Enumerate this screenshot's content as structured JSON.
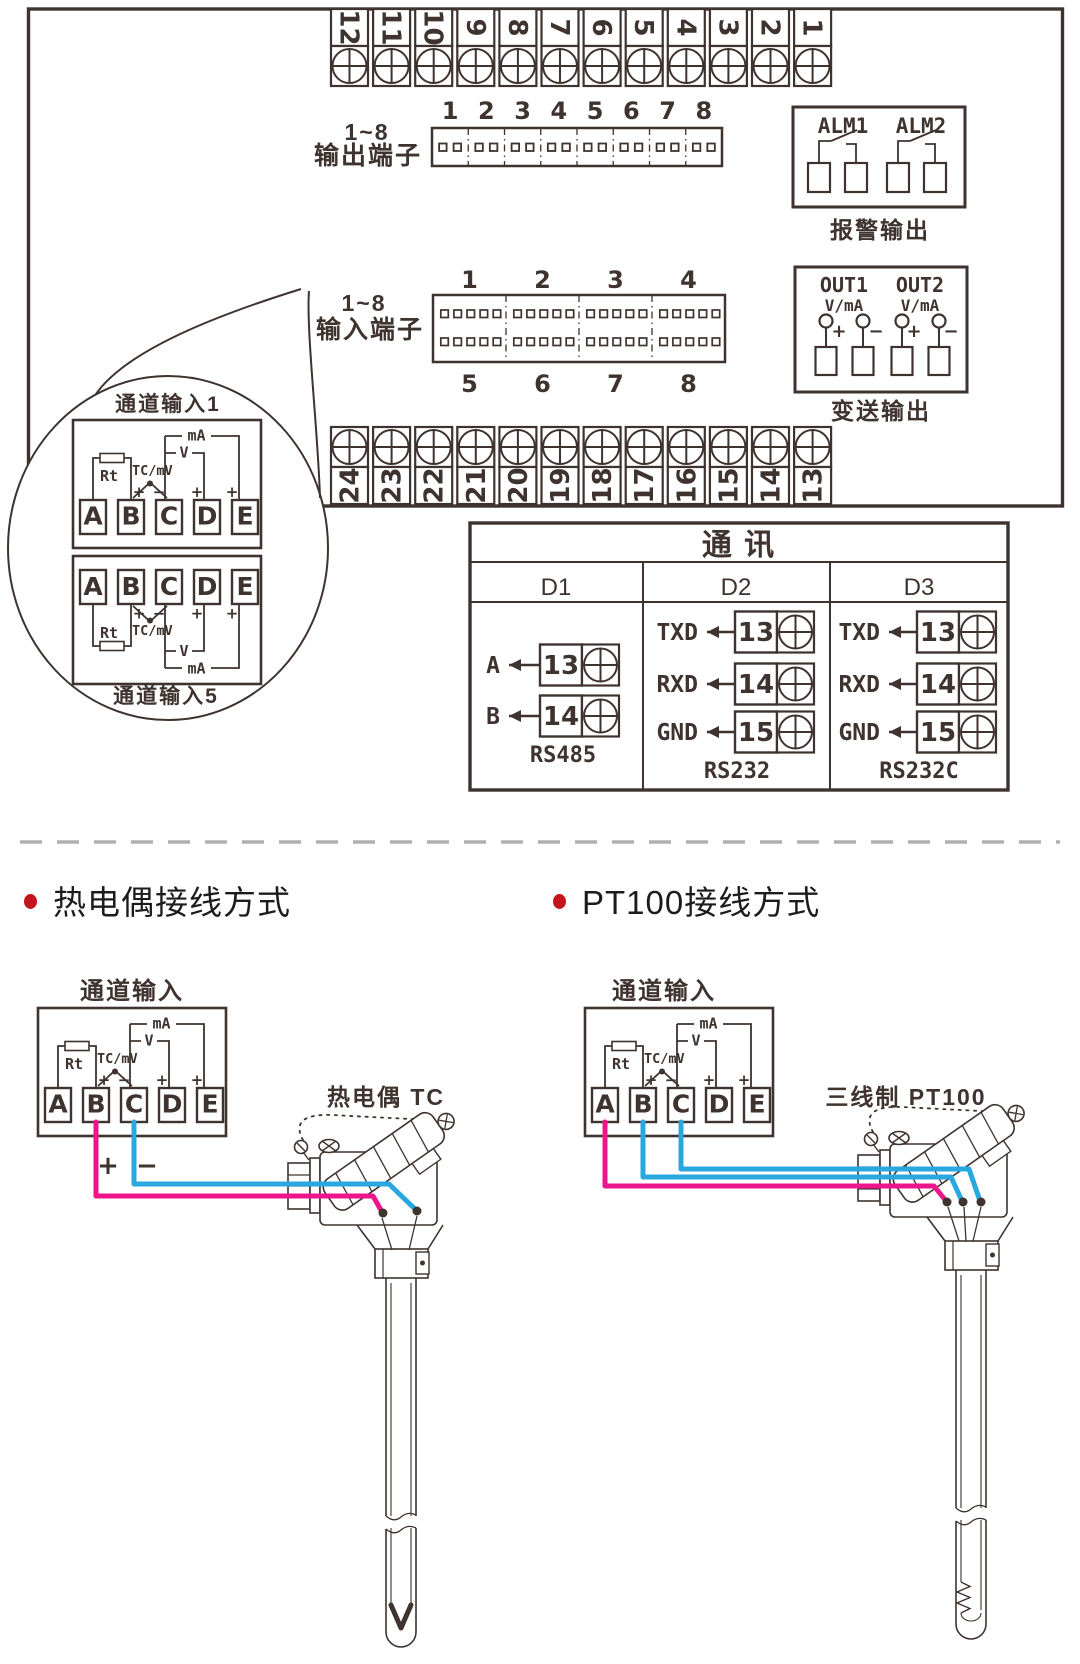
{
  "colors": {
    "line": "#3e332e",
    "wire_magenta": "#ec158c",
    "wire_cyan": "#29a8e0",
    "bullet_red": "#c3161c",
    "divider_gray": "#b0b0b2"
  },
  "top_panel": {
    "top_terminal_numbers": [
      "12",
      "11",
      "10",
      "9",
      "8",
      "7",
      "6",
      "5",
      "4",
      "3",
      "2",
      "1"
    ],
    "bottom_terminal_numbers": [
      "24",
      "23",
      "22",
      "21",
      "20",
      "19",
      "18",
      "17",
      "16",
      "15",
      "14",
      "13"
    ],
    "output_block": {
      "label_line1": "1~8",
      "label_line2": "输出端子",
      "numbers": [
        "1",
        "2",
        "3",
        "4",
        "5",
        "6",
        "7",
        "8"
      ]
    },
    "input_block": {
      "label_line1": "1~8",
      "label_line2": "输入端子",
      "top_numbers": [
        "1",
        "2",
        "3",
        "4"
      ],
      "bottom_numbers": [
        "5",
        "6",
        "7",
        "8"
      ]
    },
    "alarm_block": {
      "alm1": "ALM1",
      "alm2": "ALM2",
      "caption": "报警输出"
    },
    "transmit_block": {
      "out1": "OUT1",
      "out2": "OUT2",
      "vma": "V/mA",
      "plus": "+",
      "minus": "−",
      "caption": "变送输出"
    }
  },
  "balloon": {
    "title_top": "通道输入1",
    "title_bottom": "通道输入5"
  },
  "channel_box": {
    "terminals": [
      "A",
      "B",
      "C",
      "D",
      "E"
    ],
    "rt_label": "Rt",
    "tc_label": "TC/mV",
    "v_label": "V",
    "ma_label": "mA",
    "plus": "+",
    "minus": "−"
  },
  "comm_table": {
    "title": "通  讯",
    "columns": [
      {
        "name": "D1",
        "caption": "RS485",
        "rows": [
          {
            "label": "A",
            "terminal": "13"
          },
          {
            "label": "B",
            "terminal": "14"
          }
        ]
      },
      {
        "name": "D2",
        "caption": "RS232",
        "rows": [
          {
            "label": "TXD",
            "terminal": "13"
          },
          {
            "label": "RXD",
            "terminal": "14"
          },
          {
            "label": "GND",
            "terminal": "15"
          }
        ]
      },
      {
        "name": "D3",
        "caption": "RS232C",
        "rows": [
          {
            "label": "TXD",
            "terminal": "13"
          },
          {
            "label": "RXD",
            "terminal": "14"
          },
          {
            "label": "GND",
            "terminal": "15"
          }
        ]
      }
    ]
  },
  "bottom": {
    "left": {
      "heading": "热电偶接线方式",
      "box_title": "通道输入",
      "wire_plus": "+",
      "wire_minus": "−",
      "sensor_label": "热电偶 TC"
    },
    "right": {
      "heading": "PT100接线方式",
      "box_title": "通道输入",
      "sensor_label": "三线制 PT100"
    }
  }
}
